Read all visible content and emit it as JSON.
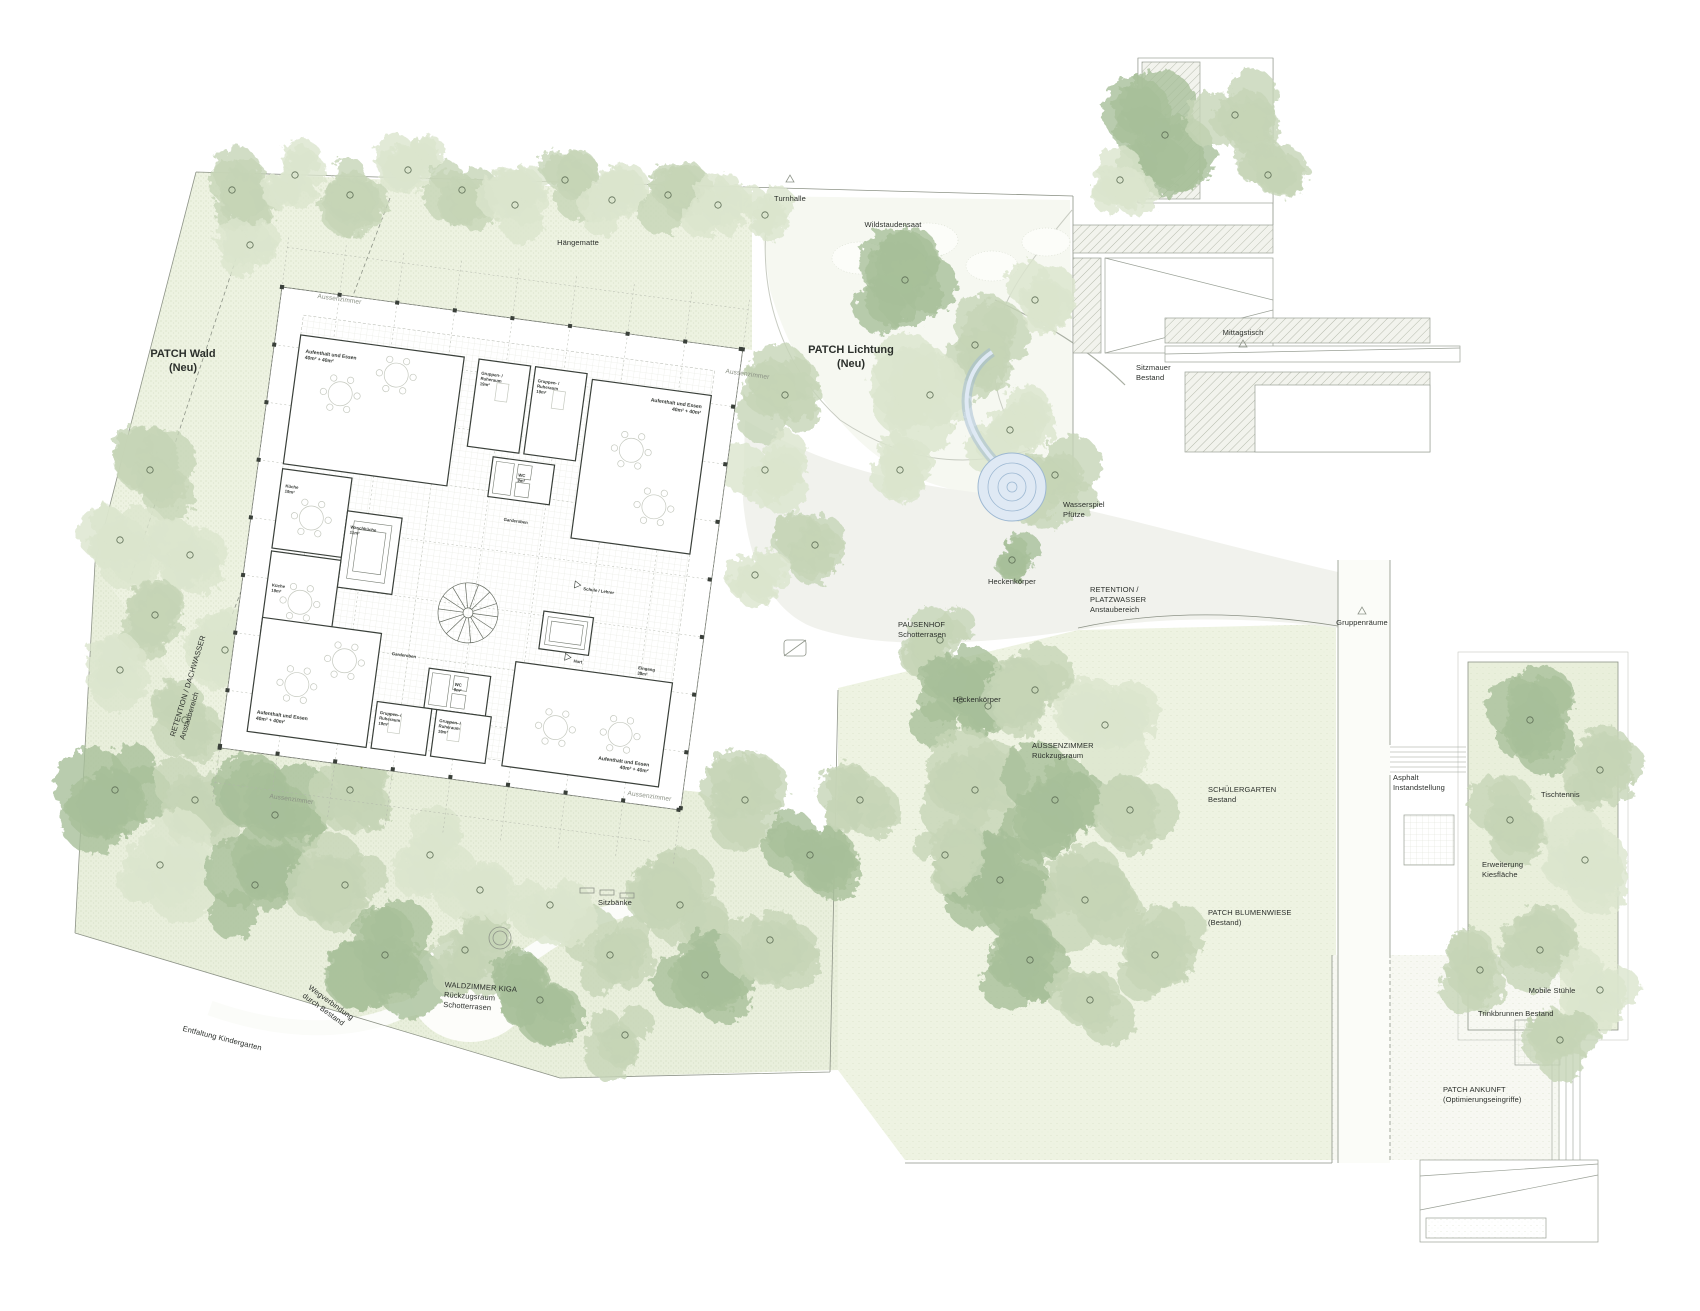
{
  "colors": {
    "tree_light": "#dbe5cd",
    "tree_mid": "#c6d5b6",
    "tree_dark": "#a7bf9a",
    "trunk_line": "#5d6d55",
    "veg_base": "#edf2e1",
    "veg_faint": "#f4f7ec",
    "water_fill": "#dfe9f4",
    "water_line": "#9db8d2",
    "branch_plant": "#93a457",
    "label_ink": "#2b2f2b"
  },
  "site": {
    "labels": [
      {
        "id": "patch-wald",
        "x": 183,
        "y": 347,
        "rot": 0,
        "align": "center",
        "size": "lg",
        "lines": [
          "PATCH Wald",
          "(Neu)"
        ]
      },
      {
        "id": "haengematte",
        "x": 578,
        "y": 238,
        "rot": 0,
        "align": "center",
        "size": "sm",
        "lines": [
          "Hängematte"
        ]
      },
      {
        "id": "turnhalle",
        "x": 790,
        "y": 194,
        "rot": 0,
        "align": "center",
        "size": "sm",
        "lines": [
          "Turnhalle"
        ]
      },
      {
        "id": "wildstaudensaat",
        "x": 893,
        "y": 220,
        "rot": 0,
        "align": "center",
        "size": "sm",
        "lines": [
          "Wildstaudensaat"
        ]
      },
      {
        "id": "patch-lichtung",
        "x": 851,
        "y": 343,
        "rot": 0,
        "align": "center",
        "size": "lg",
        "lines": [
          "PATCH Lichtung",
          "(Neu)"
        ]
      },
      {
        "id": "sitzmauer",
        "x": 1136,
        "y": 363,
        "rot": 0,
        "align": "left",
        "size": "sm",
        "lines": [
          "Sitzmauer",
          "Bestand"
        ]
      },
      {
        "id": "mittagstisch",
        "x": 1243,
        "y": 328,
        "rot": 0,
        "align": "center",
        "size": "sm",
        "lines": [
          "Mittagstisch"
        ]
      },
      {
        "id": "wasserspiel",
        "x": 1063,
        "y": 500,
        "rot": 0,
        "align": "left",
        "size": "sm",
        "lines": [
          "Wasserspiel",
          "Pfütze"
        ]
      },
      {
        "id": "heckenkoerper-1",
        "x": 988,
        "y": 577,
        "rot": 0,
        "align": "left",
        "size": "sm",
        "lines": [
          "Heckenkörper"
        ]
      },
      {
        "id": "retention-platzwasser",
        "x": 1090,
        "y": 585,
        "rot": 0,
        "align": "left",
        "size": "sm",
        "lines": [
          "RETENTION /",
          "PLATZWASSER",
          "Anstaubereich"
        ]
      },
      {
        "id": "pausenhof",
        "x": 898,
        "y": 620,
        "rot": 0,
        "align": "left",
        "size": "sm",
        "lines": [
          "PAUSENHOF",
          "Schotterrasen"
        ]
      },
      {
        "id": "heckenkoerper-2",
        "x": 953,
        "y": 695,
        "rot": 0,
        "align": "left",
        "size": "sm",
        "lines": [
          "Heckenkörper"
        ]
      },
      {
        "id": "aussenzimmer-area",
        "x": 1032,
        "y": 741,
        "rot": 0,
        "align": "left",
        "size": "sm",
        "lines": [
          "AUSSENZIMMER",
          "Rückzugsraum"
        ]
      },
      {
        "id": "schuelergarten",
        "x": 1208,
        "y": 785,
        "rot": 0,
        "align": "left",
        "size": "sm",
        "lines": [
          "SCHÜLERGARTEN",
          "Bestand"
        ]
      },
      {
        "id": "patch-blumenwiese",
        "x": 1208,
        "y": 908,
        "rot": 0,
        "align": "left",
        "size": "sm",
        "lines": [
          "PATCH BLUMENWIESE",
          "(Bestand)"
        ]
      },
      {
        "id": "gruppenraeume",
        "x": 1362,
        "y": 618,
        "rot": 0,
        "align": "center",
        "size": "sm",
        "lines": [
          "Gruppenräume"
        ]
      },
      {
        "id": "asphalt",
        "x": 1393,
        "y": 773,
        "rot": 0,
        "align": "left",
        "size": "sm",
        "lines": [
          "Asphalt",
          "Instandstellung"
        ]
      },
      {
        "id": "tischtennis",
        "x": 1541,
        "y": 790,
        "rot": 0,
        "align": "left",
        "size": "sm",
        "lines": [
          "Tischtennis"
        ]
      },
      {
        "id": "erweiterung-kies",
        "x": 1482,
        "y": 860,
        "rot": 0,
        "align": "left",
        "size": "sm",
        "lines": [
          "Erweiterung",
          "Kiesfläche"
        ]
      },
      {
        "id": "mobile-stuehle",
        "x": 1552,
        "y": 986,
        "rot": 0,
        "align": "center",
        "size": "sm",
        "lines": [
          "Mobile Stühle"
        ]
      },
      {
        "id": "trinkbrunnen",
        "x": 1478,
        "y": 1009,
        "rot": 0,
        "align": "left",
        "size": "sm",
        "lines": [
          "Trinkbrunnen Bestand"
        ]
      },
      {
        "id": "patch-ankunft",
        "x": 1443,
        "y": 1085,
        "rot": 0,
        "align": "left",
        "size": "sm",
        "lines": [
          "PATCH ANKUNFT",
          "(Optimierungseingriffe)"
        ]
      },
      {
        "id": "retention-dachwasser",
        "x": 168,
        "y": 735,
        "rot": -73,
        "align": "left",
        "size": "sm",
        "lines": [
          "RETENTION / DACHWASSER",
          "Anstaubereich"
        ]
      },
      {
        "id": "waldzimmer-kiga",
        "x": 445,
        "y": 980,
        "rot": 4,
        "align": "left",
        "size": "sm",
        "lines": [
          "WALDZIMMER KIGA",
          "Rückzugsraum",
          "Schotterrasen"
        ]
      },
      {
        "id": "sitzbaenke",
        "x": 598,
        "y": 898,
        "rot": 0,
        "align": "left",
        "size": "sm",
        "lines": [
          "Sitzbänke"
        ]
      },
      {
        "id": "entfaltung",
        "x": 184,
        "y": 1024,
        "rot": 14,
        "align": "left",
        "size": "sm",
        "lines": [
          "Entfaltung Kindergarten"
        ]
      },
      {
        "id": "wegverbindung",
        "x": 312,
        "y": 983,
        "rot": 36,
        "align": "left",
        "size": "sm",
        "lines": [
          "Wegverbindung",
          "durch Bestand"
        ]
      },
      {
        "id": "aussenzimmer-tl",
        "x": 318,
        "y": 293,
        "rot": 8,
        "align": "left",
        "size": "sm",
        "muted": true,
        "lines": [
          "Aussenzimmer"
        ]
      },
      {
        "id": "aussenzimmer-tr",
        "x": 726,
        "y": 368,
        "rot": 8,
        "align": "left",
        "size": "sm",
        "muted": true,
        "lines": [
          "Aussenzimmer"
        ]
      },
      {
        "id": "aussenzimmer-bl",
        "x": 270,
        "y": 793,
        "rot": 8,
        "align": "left",
        "size": "sm",
        "muted": true,
        "lines": [
          "Aussenzimmer"
        ]
      },
      {
        "id": "aussenzimmer-br",
        "x": 628,
        "y": 790,
        "rot": 8,
        "align": "left",
        "size": "sm",
        "muted": true,
        "lines": [
          "Aussenzimmer"
        ]
      }
    ]
  },
  "building": {
    "x": 282,
    "y": 287,
    "size": 465,
    "rotation_deg": 7.7,
    "rooms": [
      {
        "id": "aufenthalt-tl",
        "x": 32,
        "y": 62,
        "anchor": "start",
        "fs": 5,
        "lines": [
          "Aufenthalt und Essen",
          "40m² + 40m²"
        ]
      },
      {
        "id": "gruppenraum-1",
        "x": 209,
        "y": 60,
        "anchor": "start",
        "fs": 4.3,
        "lines": [
          "Gruppen- /",
          "Ruheraum",
          "19m²"
        ]
      },
      {
        "id": "gruppenraum-2",
        "x": 266,
        "y": 60,
        "anchor": "start",
        "fs": 4.3,
        "lines": [
          "Gruppen- /",
          "Ruheraum",
          "19m²"
        ]
      },
      {
        "id": "aufenthalt-tr",
        "x": 432,
        "y": 64,
        "anchor": "end",
        "fs": 5,
        "lines": [
          "Aufenthalt und Essen",
          "40m² + 40m²"
        ]
      },
      {
        "id": "wc-oben",
        "x": 263,
        "y": 156,
        "anchor": "middle",
        "fs": 4.3,
        "lines": [
          "WC",
          "9m²"
        ]
      },
      {
        "id": "garderoben-oben",
        "x": 263,
        "y": 202,
        "anchor": "middle",
        "fs": 4.3,
        "lines": [
          "Garderoben"
        ]
      },
      {
        "id": "kueche-1",
        "x": 30,
        "y": 198,
        "anchor": "start",
        "fs": 4.3,
        "lines": [
          "Küche",
          "19m²"
        ]
      },
      {
        "id": "waschkueche",
        "x": 100,
        "y": 230,
        "anchor": "start",
        "fs": 4.3,
        "lines": [
          "Waschküche",
          "11m²"
        ]
      },
      {
        "id": "kueche-2",
        "x": 30,
        "y": 298,
        "anchor": "start",
        "fs": 4.3,
        "lines": [
          "Küche",
          "19m²"
        ]
      },
      {
        "id": "schule-lehrer",
        "x": 339,
        "y": 260,
        "anchor": "start",
        "fs": 4.3,
        "lines": [
          "Schule / Lehrer"
        ]
      },
      {
        "id": "hort",
        "x": 339,
        "y": 333,
        "anchor": "start",
        "fs": 4.3,
        "lines": [
          "Hort"
        ]
      },
      {
        "id": "eingang",
        "x": 404,
        "y": 331,
        "anchor": "start",
        "fs": 4.3,
        "lines": [
          "Eingang",
          "38m²"
        ]
      },
      {
        "id": "garderoben-unten",
        "x": 158,
        "y": 350,
        "anchor": "start",
        "fs": 4.3,
        "lines": [
          "Garderoben"
        ]
      },
      {
        "id": "wc-unten",
        "x": 228,
        "y": 372,
        "anchor": "middle",
        "fs": 4.3,
        "lines": [
          "WC",
          "9m²"
        ]
      },
      {
        "id": "gruppenraum-3",
        "x": 154,
        "y": 410,
        "anchor": "start",
        "fs": 4.3,
        "lines": [
          "Gruppen- /",
          "Ruheraum",
          "19m²"
        ]
      },
      {
        "id": "gruppenraum-4",
        "x": 214,
        "y": 410,
        "anchor": "start",
        "fs": 4.3,
        "lines": [
          "Gruppen- /",
          "Ruheraum",
          "19m²"
        ]
      },
      {
        "id": "aufenthalt-bl",
        "x": 32,
        "y": 426,
        "anchor": "start",
        "fs": 5,
        "lines": [
          "Aufenthalt und Essen",
          "40m² + 40m²"
        ]
      },
      {
        "id": "aufenthalt-br",
        "x": 428,
        "y": 426,
        "anchor": "end",
        "fs": 5,
        "lines": [
          "Aufenthalt und Essen",
          "40m² + 40m²"
        ]
      }
    ]
  }
}
